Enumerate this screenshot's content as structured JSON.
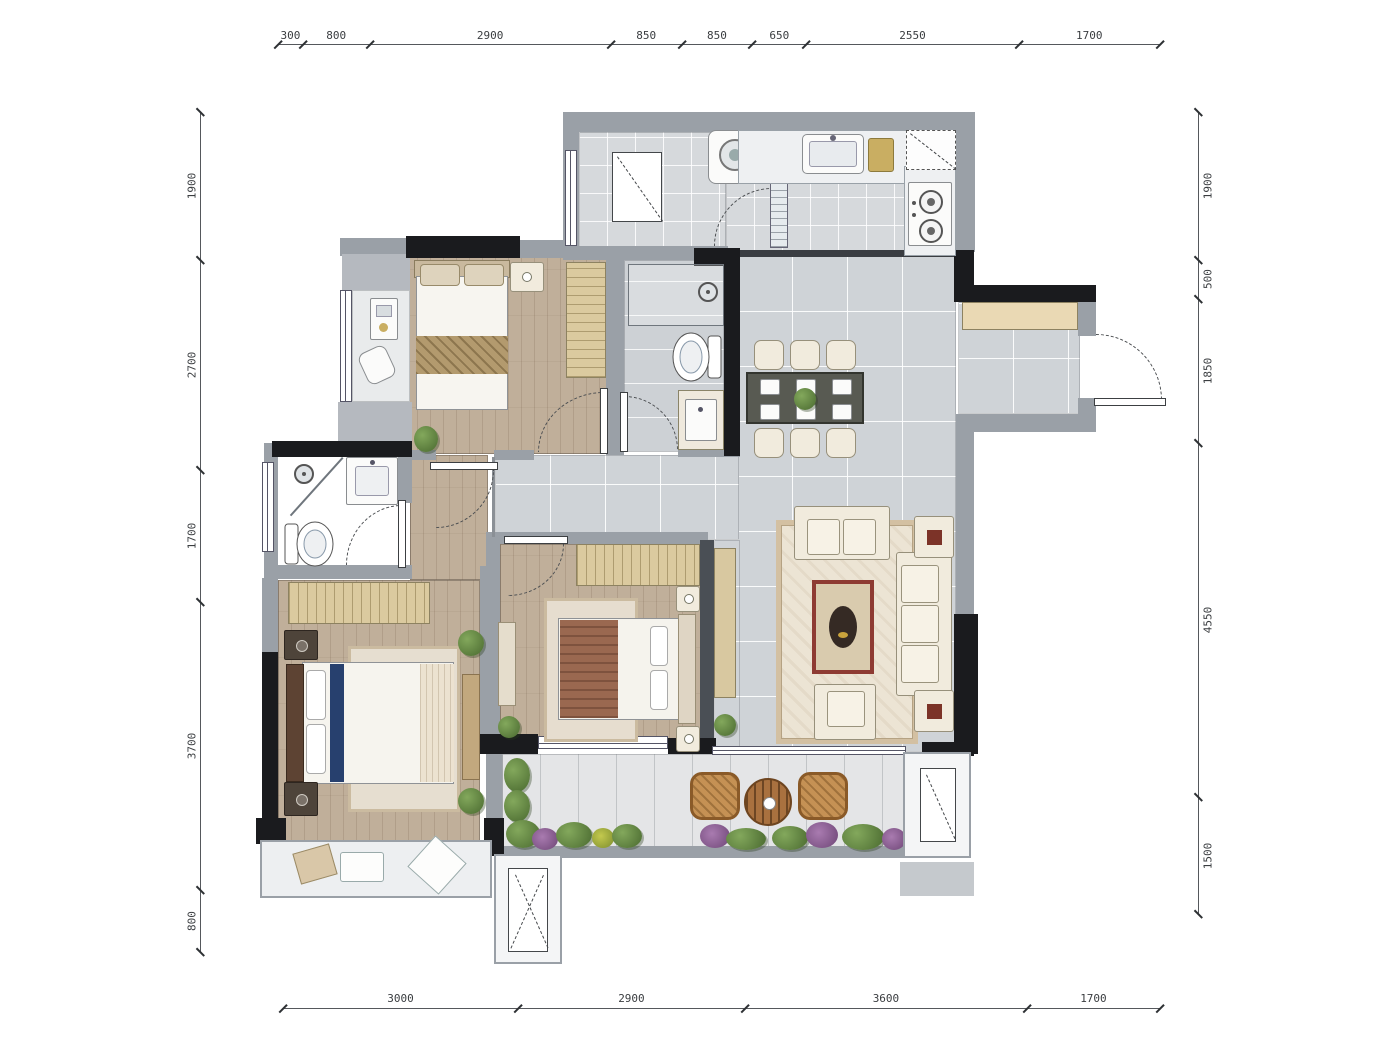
{
  "dimensions": {
    "top": [
      300,
      800,
      2900,
      850,
      850,
      650,
      2550,
      1700
    ],
    "bottom": [
      3000,
      2900,
      3600,
      1700
    ],
    "left": [
      1900,
      2700,
      1700,
      3700,
      800
    ],
    "right": [
      1900,
      500,
      1850,
      4550,
      1500
    ]
  },
  "palette": {
    "wall_gray": "#9aa0a7",
    "wall_black": "#1a1b1e",
    "wood_floor": "#c0af9a",
    "bath_tile": "#cdd1d5",
    "living_tile": "#cfd3d7",
    "balcony_tile": "#e4e5e7",
    "furniture_cream": "#f1ebdd",
    "wardrobe_tan": "#dbca9f",
    "coffee_table_red": "#8e3b33",
    "bed_runner_blue": "#27406e",
    "plant_green": "#5d8544",
    "rattan_brown": "#c28e54"
  }
}
